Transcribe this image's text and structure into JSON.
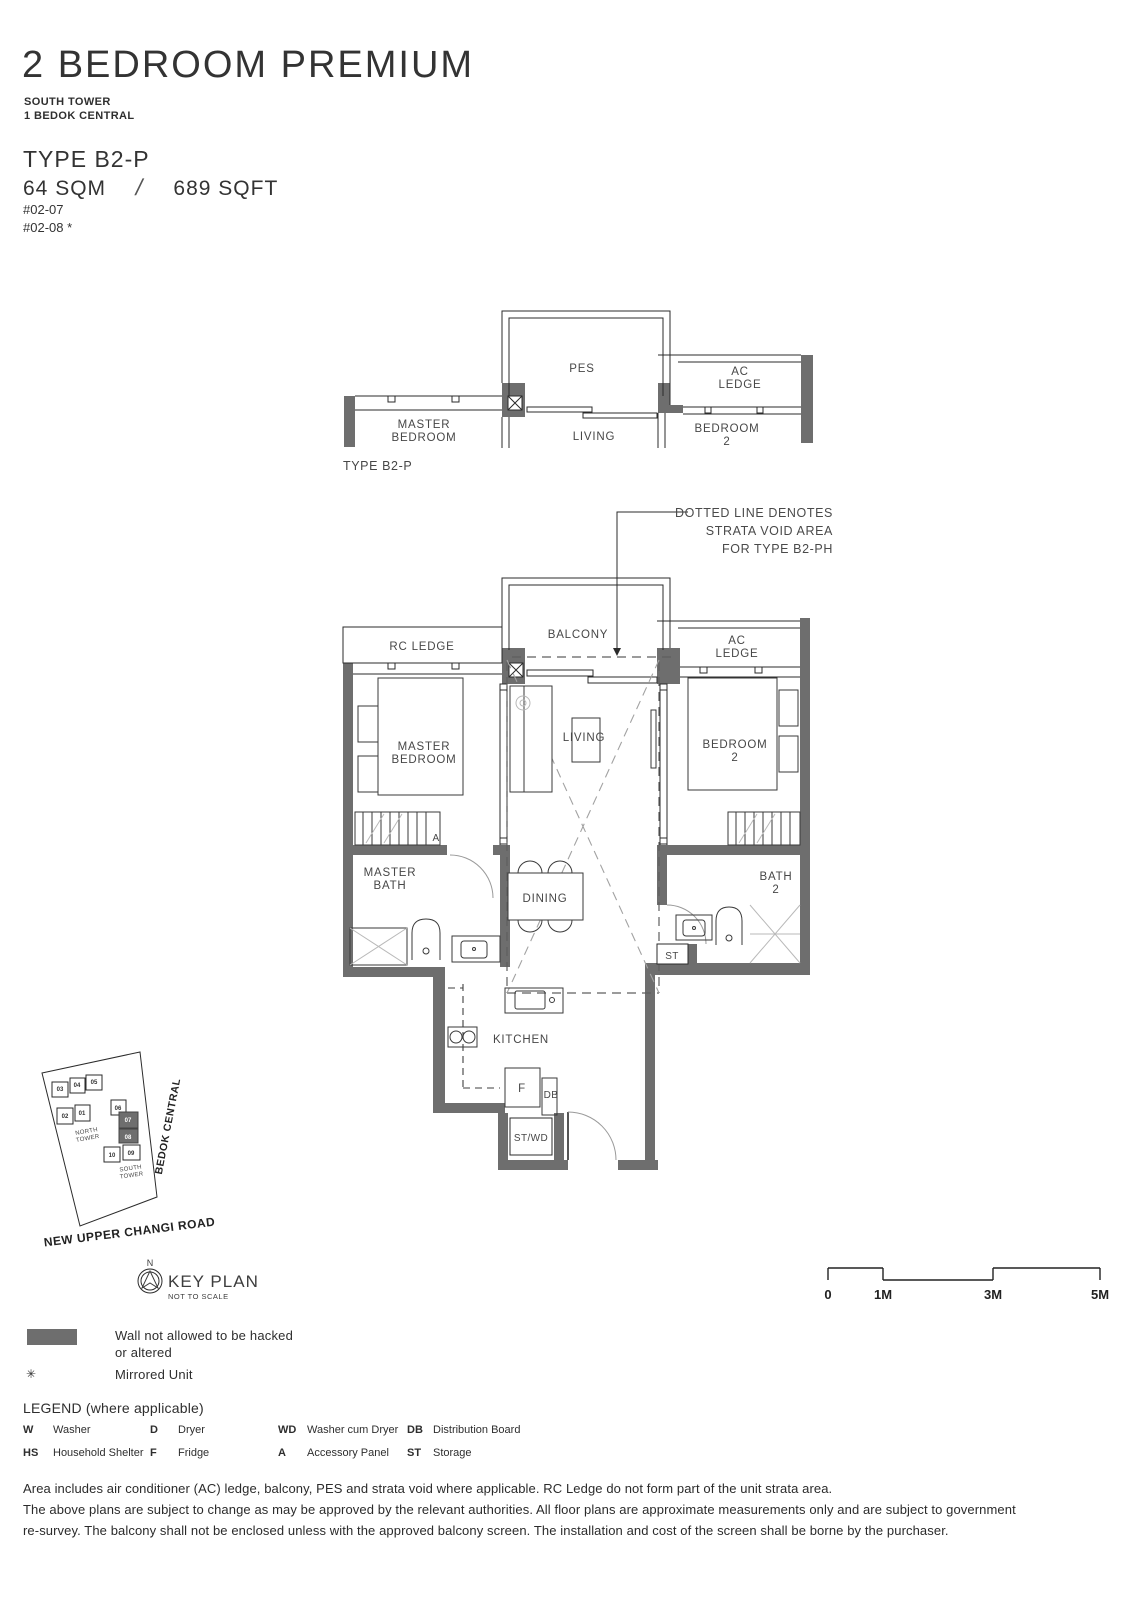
{
  "colors": {
    "wall": "#6e6e6e",
    "line": "#2b2b2b",
    "text": "#3d3d3d"
  },
  "header": {
    "title": "2 BEDROOM PREMIUM",
    "tower": "SOUTH TOWER",
    "project": "1 BEDOK CENTRAL",
    "unit_type": "TYPE B2-P",
    "area_sqm": "64 SQM",
    "area_divider": "/",
    "area_sqft": "689 SQFT",
    "unit_1": "#02-07",
    "unit_2": "#02-08 *"
  },
  "schematic": {
    "pes": "PES",
    "ac_ledge_1": "AC",
    "ac_ledge_2": "LEDGE",
    "master_bedroom_1": "MASTER",
    "master_bedroom_2": "BEDROOM",
    "living": "LIVING",
    "bedroom2_1": "BEDROOM",
    "bedroom2_2": "2",
    "caption": "TYPE B2-P"
  },
  "annotation": {
    "line1": "DOTTED LINE DENOTES",
    "line2": "STRATA VOID AREA",
    "line3": "FOR TYPE B2-PH"
  },
  "floorplan": {
    "balcony": "BALCONY",
    "rc_ledge": "RC LEDGE",
    "ac_ledge_1": "AC",
    "ac_ledge_2": "LEDGE",
    "master_bedroom_1": "MASTER",
    "master_bedroom_2": "BEDROOM",
    "living": "LIVING",
    "bedroom2_1": "BEDROOM",
    "bedroom2_2": "2",
    "master_bath_1": "MASTER",
    "master_bath_2": "BATH",
    "dining": "DINING",
    "bath2_1": "BATH",
    "bath2_2": "2",
    "st": "ST",
    "kitchen": "KITCHEN",
    "fridge": "F",
    "db": "DB",
    "stwd": "ST/WD",
    "accessory_panel": "A"
  },
  "keyplan": {
    "title": "KEY PLAN",
    "subtitle": "NOT TO SCALE",
    "north": "N",
    "road": "NEW UPPER CHANGI ROAD",
    "street": "BEDOK CENTRAL",
    "north_tower_1": "NORTH",
    "north_tower_2": "TOWER",
    "south_tower_1": "SOUTH",
    "south_tower_2": "TOWER",
    "units": [
      "03",
      "04",
      "05",
      "02",
      "01",
      "06",
      "07",
      "08",
      "10",
      "09"
    ]
  },
  "scalebar": {
    "labels": [
      "0",
      "1M",
      "3M",
      "5M"
    ]
  },
  "legend": {
    "wall_note_1": "Wall not allowed to be hacked",
    "wall_note_2": "or altered",
    "mirror_symbol": "✳",
    "mirror_note": "Mirrored Unit",
    "title": "LEGEND (where applicable)",
    "items": [
      {
        "abbr": "W",
        "label": "Washer"
      },
      {
        "abbr": "D",
        "label": "Dryer"
      },
      {
        "abbr": "WD",
        "label": "Washer cum Dryer"
      },
      {
        "abbr": "DB",
        "label": "Distribution Board"
      },
      {
        "abbr": "HS",
        "label": "Household Shelter"
      },
      {
        "abbr": "F",
        "label": "Fridge"
      },
      {
        "abbr": "A",
        "label": "Accessory Panel"
      },
      {
        "abbr": "ST",
        "label": "Storage"
      }
    ]
  },
  "disclaimer": {
    "line1": "Area includes air conditioner (AC) ledge, balcony, PES and strata void where applicable.  RC Ledge do not form part of the unit strata area.",
    "line2": "The above plans are subject to change as may be approved by the relevant authorities. All floor plans are approximate measurements only and are subject to government",
    "line3": "re-survey. The balcony shall not be enclosed unless with the approved balcony screen. The installation and cost of the screen shall be borne by the purchaser."
  }
}
